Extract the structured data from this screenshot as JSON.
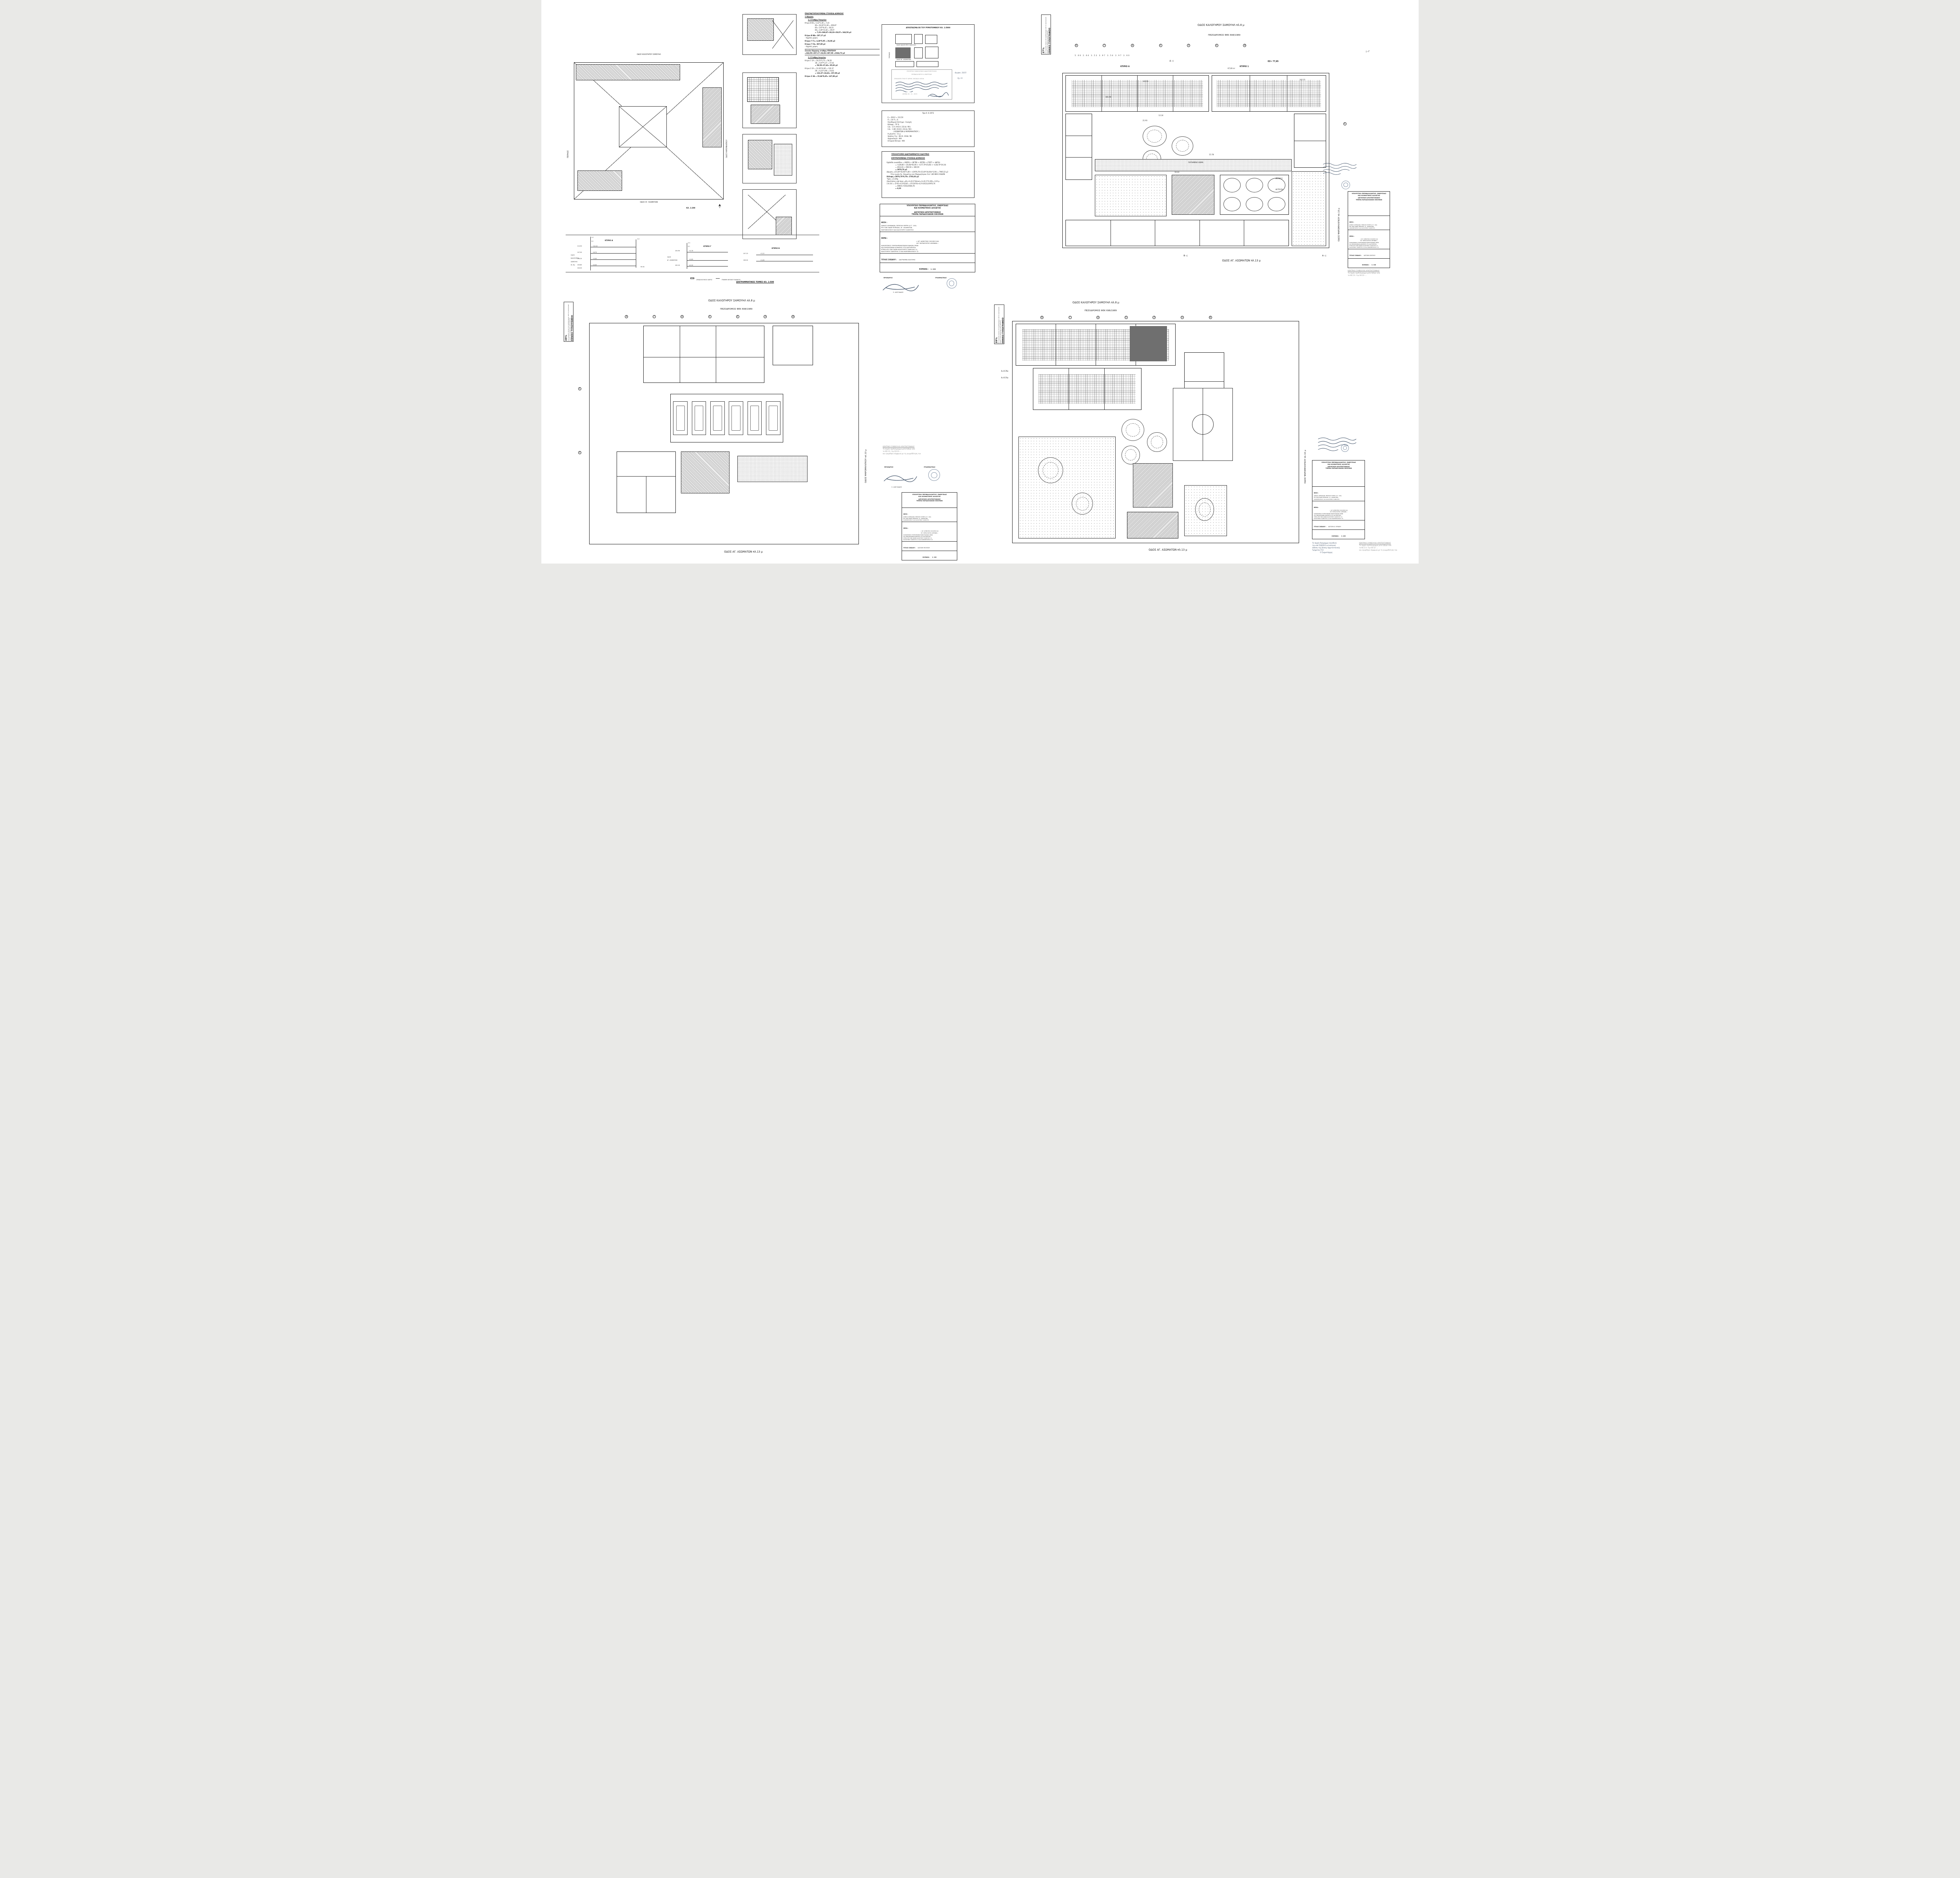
{
  "page": {
    "background": "#e9e9e7",
    "paper": "#ffffff",
    "ink": "#1b1b1b"
  },
  "titleblock": {
    "ministry_line1": "ΥΠΟΥΡΓΕΙΟ ΠΕΡΙΒΑΛΛΟΝΤΟΣ, ΕΝΕΡΓΕΙΑΣ",
    "ministry_line2": "ΚΑΙ ΚΛΙΜΑΤΙΚΗΣ ΑΛΛΑΓΗΣ",
    "dept_line1": "ΔΙΕΥΘΥΝΣΗ ΑΡΧΙΤΕΚΤΟΝΙΚΗΣ",
    "dept_line2": "ΤΜΗΜΑ ΠΑΡΑΔΟΣΙΑΚΩΝ ΟΙΚΙΣΜΩΝ",
    "thesi_label": "ΘΕΣΗ :",
    "thesi_line1": "ΔΗΜΟΣ ΑΘΗΝΑΙΩΝ, ΠΕΡΙΟΧΗ ΨΥΡΡΗ (Ο.Τ. 100)",
    "thesi_line2": "ΕΠΙ ΤΩΝ ΟΔΩΝ ΠΕΙΡΑΙΩΣ, ΑΓ. ΑΣΩΜΑΤΩΝ,",
    "thesi_line3": "ΨΑΡΟΜΗΛΙΓΚΟΥ ΚΑΙ ΚΑΛΟΓΗΡΟΥ ΣΑΜΟΥΗΛ",
    "thema_label": "ΘΕΜΑ :",
    "thema_line1": "« 49° ΔΗΜΟΤΙΚΟ ΣΧΟΛΕΙΟ ΚΑΙ",
    "thema_line2": "84° ΝΗΠΙΑΓΩΓΕΙΟ ΑΘΗΝΩΝ »",
    "thema_line3": "ΚΑΘΟΡΙΣΜΟΣ ΣΥΜΠΛΗΡΩΜΑΤΙΚΩΝ ΕΙΔΙΚΩΝ ΟΡΩΝ",
    "thema_line4": "ΚΑΙ ΠΕΡΙΟΡΙΣΜΩΝ ΔΟΜΗΣΗΣ ΣΤΑ ΔΙΑΤΗΡΗΤΕΑ",
    "thema_line5": "ΚΤΙΡΙΑ ΕΠΙ ΤΩΝ ΟΔΩΝ ΚΑΛΟΓΗΡΟΥ ΣΑΜΟΥΗΛ 11,",
    "thema_line6": "ΚΑΛΟΓΗΡΟΥ ΣΑΜΟΥΗΛ 13 ΚΑΙ ΨΑΡΟΜΗΛΙΓΚΟΥ 12",
    "title_label": "ΤΙΤΛΟΣ ΣΧΕΔΙΟΥ :",
    "scale_label": "ΚΛΙΜΑΚΑ :"
  },
  "np_stamp": {
    "title": "ΕΘΝΙΚΟ ΤΥΠΟΓΡΑΦΕΙΟ",
    "body": "Για τεχνικούς λόγους στο σχεδιάγραμμα, από το ηλεκτρονικό αρχείο, έγινε σμίκρυνση κατά ποσοστό",
    "pct_tr": "37%",
    "pct_bl": "39%",
    "pct_br": "39%"
  },
  "approval": {
    "heading": "ΚΕΝΤΡΙΚΟ ΣΥΜΒΟΥΛΙΟ ΑΡΧΙΤΕΚΤΟΝΙΚΗΣ",
    "line1": "Το παρόν σχεδιάγραμμα μελετήθηκε από",
    "line2": "το ΚΕ.Σ.Α. την 04-12-....",
    "line3": "και εγκρίθηκε σύμφωνα με τη γνωμοδότηση του",
    "president_label": "ΠΡΟΕΔΡΟΣ",
    "president_name": "Σ. ΑΛΕΞΙΑΔΗΣ",
    "secretary_label": "ΓΡΑΜΜΑΤΕΑΣ"
  },
  "accompany": {
    "line1": "Το παρόν διάγραμμα συνοδεύει",
    "line2": "την από 5|9|2013 αιτιολογική",
    "line3": "έκθεση της Δ/νσης Αρχιτεκτονικής",
    "line4": "Τμήματος Π.Ο.",
    "line5": "Ο Τμηματάρχης"
  },
  "streets": {
    "top_name": "ΟΔΟΣ ΚΑΛΟΓΗΡΟΥ ΣΑΜΟΥΗΛ πλ.8 μ",
    "top_sub": "ΠΕΖΟΔΡΟΜΟΣ ΦΕΚ 698/1989",
    "bottom_name": "ΟΔΟΣ ΑΓ. ΑΣΩΜΑΤΩΝ πλ.13 μ",
    "right_name": "ΟΔΟΣ ΨΑΡΟΜΗΛΙΓΚΟΥ πλ.10 μ",
    "top_short": "ΟΔΟΣ ΚΑΛΟΓΗΡΟΥ ΣΑΜΟΥΗΛ",
    "bottom_short": "ΟΔΟΣ ΑΓ. ΑΣΩΜΑΤΩΝ",
    "right_short": "ΟΔΟΣ ΨΑΡΟΜΗΛΙΓΚΟΥ",
    "peiraios": "ΠΕΙΡΑΙΩΣ"
  },
  "grid": {
    "bubbles": [
      "Β",
      "Γ",
      "Δ",
      "Ε",
      "Ζ",
      "Η",
      "Θ"
    ],
    "dims": "5.06      2.64      3.53      3.97      3.54      3.97      3.60",
    "right_bubble": "Α",
    "marker_d": "Δ ◁",
    "marker_g": "▷ Γ",
    "marker_b": "Β ◁",
    "marker_a": "Α ◁",
    "e_bub": "Ε",
    "z_bub": "Ζ"
  },
  "sheet_tl": {
    "title": "ΔΙΑΓΡΑΜΜΑ ΚΑΛΥΨΗΣ",
    "scale": "1: 200",
    "plan_scale": "ΚΛ. 1:200",
    "calc1_heading": "ΠΡΑΓΜΑΤΟΠΟΙΟΥΜΕΝΑ ΣΤΟΙΧΕΙΑ ΔΟΜΗΣΗΣ",
    "calc1_s1": "1   Δόμηση",
    "calc1_s11": "1.1   Στάθμη Υπογείου",
    "calc1_lines": [
      "Κτίριο Β     Β1= 5,32*1,36 = 7,23",
      "Β2= 20,20*13,36 = 269,87",
      "Β3= 5,97*6,42 = 38,33",
      "Β4= 2,46*11,82 = 29,07",
      "= 7,23+269,87+38,33+29,07= 344,50 μ2",
      "Κτίριο Β     ΒΑ= 287,17 μ2",
      "- Αρχ/κός χώρος",
      "Κτίριο Γ     Γ1= 4,38*5,95 = 26,06 μ2",
      "Κτίριο Γ     ΓΑ= 387,00 μ2",
      "- Αρχ/κός χώρος"
    ],
    "calc1_total1": "Σύνολο δόμησης στάθμη ΥΠΟΓΕΙΟΥ",
    "calc1_total2": "=344,50+287,17+26,06+387,00 =1044,73 μ2",
    "calc1_s12": "1.2   Στάθμη Ισογείου",
    "calc2_lines": [
      "Κτίριο 1     1Α = 10,21*5,73 = 58,50",
      "1Β = 6,97*5,37 = 37,42",
      "= 58,50+37,42= 95,92 μ2",
      "Κτίριο 2     2Α = 12,20*10,85 = 132,37",
      "2Β = 6,22*3,96 = 24,63",
      "= 132,37+24,63= 157,00 μ2",
      "Κτίριο 3     3Α = 15,66*9,45= 147,98 μ2"
    ],
    "extract_title": "ΑΠΟΣΠΑΣΜΑ ΕΚ ΤΟΥ ΡΥΜΟΤΟΜΙΚΟΥ ΚΛ. 1:5000",
    "extract_stamp1": "ΥΠΟΥΡΓΕΙΟ ΠΑΡΑΓΩΓΙΚΗΣ ΑΝΑΣΥΓΚΡΟΤΗΣΗΣ",
    "extract_stamp2": "ΠΕΡΙΒΑΛΛΟΝΤΟΣ & ΕΝΕΡΓΕΙΑΣ",
    "extract_ref": "ΣΥΝΟΔΕΥΕΙ ΤΗΝ ΥΠ' ΑΡΙΘΜ. 59006/15 ΑΠΟΦ.",
    "extract_date": "ΑΘΗΝΑ 30 - 11 - 2015",
    "extract_file": "Αρ.φακ. 33/15",
    "extract_sheet": "Σχ. 11",
    "terms_title": "Προ 9. 6.1973",
    "terms": [
      "Ε = 200        Ε = 112,50",
      "Π = 10         Π =  6",
      "Οικοδομικό Σύστημα :  Συνεχές",
      "Κάλυψη     :  70 %",
      "Σ.Δ.   :  2.0  ( Φ.Ε.Κ. 233 Δ / 98 )",
      "Σ.Δ.   :  1.80 ( Φ.Ε.Κ. 233 Δ / 98 )",
      "( ΑΣΩΜΑΤΩΝ & ΨΑΡΟΜΗΛΙΓΚΟΥ )",
      "Η μέγιστο   :  11 μ",
      "Χρήσεις Γης  :  Φ.Ε.Κ. 233Δ / 98",
      "Αρχαιολογία  :  ΝΑΙ",
      "Ιστορικό Κέντρο :  ΝΑΙ"
    ],
    "calc3_heading": "ΥΠΟΛΟΓΙΣΜΟΙ ΔΙΑΓΡΑΜΜΑΤΟΣ ΚΑΛΥΨΗΣ",
    "calc3_sub": "ΕΠΙΤΡΕΠΟΜΕΝΑ ΣΤΟΙΧΕΙΑ ΔΟΜΗΣΗΣ",
    "calc3_lines": [
      "Εμβαδόν οικοπέδου = (ΑΒΖΑ) + (ΒΓΖΒ) + (ΒΓΖΒ) + (ΓΕΖΓ) + (ΔΕΓΔ)",
      "= ½(39,80 + 24,00)*81,90 + ½(77,70*25,60) + ½(38,70*19,10)",
      "= 2612,61 + 994,56 + 369,59",
      "= 3976,76 μ2",
      "Δόμηση =(15,00*16,00)*1,80 + ((3976,76-(15,00*16,00))*2,00) = 7905,52 μ2",
      "Στην γωνία Αγ. Ασωμάτων και Ψαρομηλίγκου Σ.Δ. 1,80 ΦΕΚ 233Δ/98",
      "Κάλυψη =3976,76*0,70= 2783,83 μ2",
      "Ύψος =11,00μ",
      "Αποστάσεις από όρια =Δ1=3+(0,1*Hmax)=3+(0,1*11,00)= 4,10 μ",
      "Σ.Κ.Ο.Ε = (5*Ε1+4,5*Ε2)/Ε = (5*(1970)+4,5*(1612))/3976,76",
      "= (9850+7254)/3946,76",
      "= 4,33"
    ],
    "sections_caption": "ΔΙΑΓΡΑΜΜΑΤΙΚΕΣ ΤΟΜΕΣ ΚΛ. 1:500",
    "legend_arch": "ΑΡΧΑΙΟΛΟΓΙΚΟΣ ΧΩΡΟΣ",
    "legend_ground": "ΓΡΑΜΜΗ ΦΥΣΙΚΟΥ ΕΔΑΦΟΥΣ",
    "og": "Ο.Γ.",
    "rg": "Ρ.Γ.",
    "sec_a": {
      "name": "ΚΤΙΡΙΟ Α",
      "street1": "ΟΔΟΣ",
      "street2": "ΚΑΛΟΓΗΡΟΥ",
      "street3": "ΣΑΜΟΥΗΛ",
      "street4": "πλ. 8μ",
      "e1": "110.90",
      "l1": "+10.10",
      "e2": "107.50",
      "l2": "+6.70",
      "e3": "104.25",
      "l3": "+3.45",
      "e4": "100.80",
      "l4": "±0,00",
      "e5": "100.00",
      "ground": "99.90"
    },
    "sec_c": {
      "name": "ΚΤΙΡΙΟ Γ",
      "street1": "ΟΔΟΣ",
      "street2": "ΑΓ. ΑΣΩΜΑΤΩΝ",
      "e1": "104.96",
      "l1": "+4,78",
      "l2": "+0,83",
      "e3": "100.18",
      "l3": "±0,00"
    },
    "sec_b": {
      "name": "ΚΤΙΡΙΟ Β",
      "e1": "107.23",
      "l1": "+5,22",
      "e2": "106.00",
      "l2": "+3,99"
    }
  },
  "sheet_tr": {
    "title": "ΚΑΤΟΨΗ ΙΣΟΓΕΙΟΥ",
    "scale": "1: 100",
    "ktirio_a": "ΚΤΙΡΙΟ Α",
    "ktirio_1": "ΚΤΙΡΙΟ 1",
    "ez": "ΕΖ= 77,85",
    "avli": "ΑΥΛΗ 2",
    "fytefsi": "ΦΥΤΕΥΣΗ",
    "patimeno": "ΠΑΤΗΜΕΝΟ ΧΩΜΑ",
    "area_67": "67,00 m²",
    "lvl_10250": "102.50",
    "lvl_10190": "101.90",
    "lvl_10215": "102.15",
    "lvl_10101": "101.01",
    "lvl_10083": "100.83",
    "dim_1224": "12.24",
    "dim_2193": "21.93",
    "dim_1578": "15.78",
    "dim_1924": "19.24"
  },
  "sheet_bl": {
    "title": "ΚΑΤΟΨΗ ΥΠΟΓΕΙΟΥ",
    "scale": "1: 100"
  },
  "sheet_br": {
    "title": "ΚΑΤΟΨΗ Α' ΟΡΟΦΟΥ",
    "scale": "1: 100",
    "d1": "Δ=8,30μ",
    "d2": "Δ=8,10μ"
  }
}
